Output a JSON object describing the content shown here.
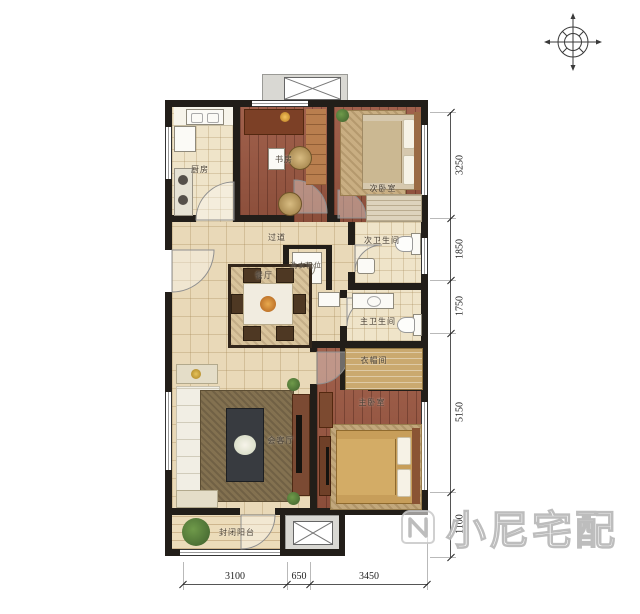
{
  "rooms": {
    "kitchen": "厨房",
    "study": "书房",
    "secondary_bedroom": "次卧室",
    "secondary_bathroom": "次卫生间",
    "hallway": "过道",
    "laundry": "洗衣机位",
    "dining": "餐厅",
    "master_bathroom": "主卫生间",
    "cloakroom": "衣帽间",
    "master_bedroom": "主卧室",
    "living_room": "会客厅",
    "balcony": "封闭阳台"
  },
  "dimensions": {
    "right": [
      "3250",
      "1850",
      "1750",
      "5150",
      "1100"
    ],
    "bottom": [
      "3100",
      "650",
      "3450"
    ]
  },
  "watermark": {
    "brand": "小尼宅配"
  },
  "colors": {
    "wall": "#221e19",
    "wood_floor": "#9b5741",
    "tile_floor": "#e9d9b8",
    "rug_living": "#837150",
    "bedding": "#c79e5a"
  }
}
